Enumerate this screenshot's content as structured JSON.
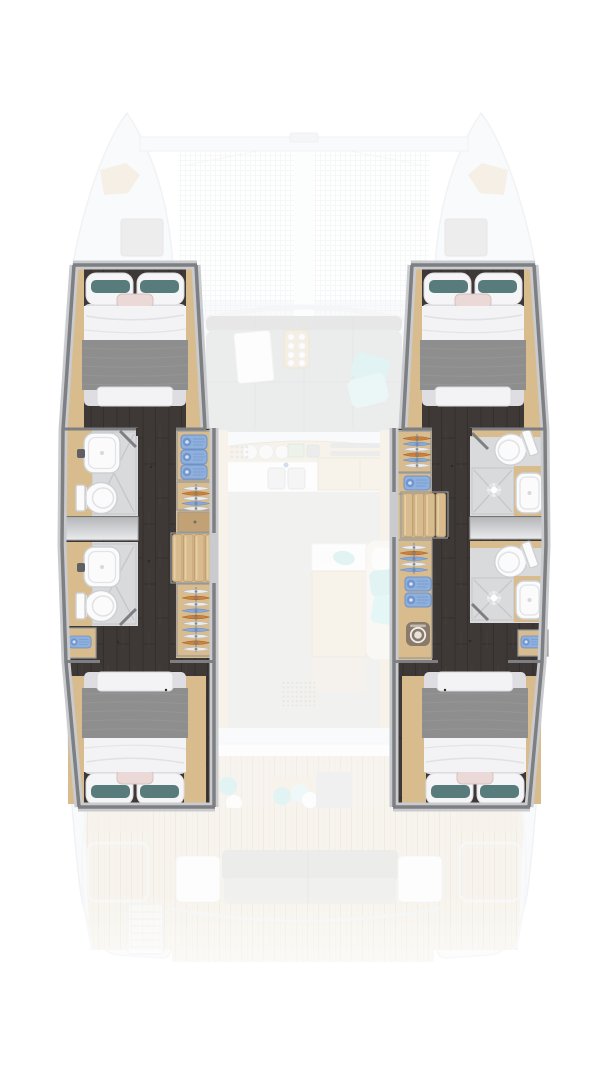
{
  "plan": {
    "vessel": "catamaran",
    "view": "top-down interior floor plan",
    "highlighted_layout": "4 double cabins and 4 shower rooms in the two hulls",
    "port_hull": {
      "forward_cabin": {
        "bed": "double, pillows forward",
        "pillow_accents": [
          "teal",
          "teal",
          "pink"
        ]
      },
      "shower_rooms": [
        {
          "fixtures": [
            "washbasin",
            "shower",
            "toilet"
          ]
        },
        {
          "fixtures": [
            "washbasin",
            "shower",
            "toilet"
          ]
        }
      ],
      "hull_window": true,
      "wardrobe_shelf_towels": 3,
      "hanging_rails": 2,
      "companionway_steps": 4,
      "towel_cabinet": true,
      "aft_cabin": {
        "bed": "double, pillows aft",
        "pillow_accents": [
          "teal",
          "teal",
          "pink"
        ]
      }
    },
    "starboard_hull": {
      "forward_cabin": {
        "bed": "double, pillows forward",
        "pillow_accents": [
          "teal",
          "teal",
          "pink"
        ]
      },
      "shower_rooms": [
        {
          "fixtures": [
            "toilet",
            "shower",
            "washbasin"
          ]
        },
        {
          "fixtures": [
            "toilet",
            "shower",
            "washbasin"
          ]
        }
      ],
      "hull_window": true,
      "wardrobe_towels": 3,
      "hanging_rails": 2,
      "companionway_steps": 4,
      "washing_machine": true,
      "aft_cabin": {
        "bed": "double, pillows aft",
        "pillow_accents": [
          "teal",
          "teal",
          "pink"
        ]
      }
    },
    "faded_exterior": [
      "bow trampoline",
      "forward crossbeam",
      "deck hatches",
      "anchor lockers",
      "saloon sofa and table",
      "serving tray with cups",
      "galley with stove and double sink",
      "dinette table and sofa",
      "speaker grille",
      "sliding door",
      "cockpit teak deck",
      "aft bench",
      "side seats",
      "swim ladder"
    ],
    "icons": {
      "washing_machine": "washer-icon"
    }
  },
  "colors": {
    "page_bg": "#ffffff",
    "wall_gray": "#7d7f82",
    "wall_light": "#c9cbce",
    "floor_dark": "#3e3936",
    "floor_seam": "#332f2b",
    "floor_streak": "#4a433c",
    "oak": "#d9bc8e",
    "oak_dark": "#c2a274",
    "oak_light": "#e8d4ae",
    "tile": "#d9dadc",
    "tile_line": "#c4c6c9",
    "fixture": "#fbfbfc",
    "fixture_line": "#ced1d4",
    "duvet": "#f3f3f5",
    "duvet_shade": "#dddde2",
    "blanket": "#8e8e8e",
    "blanket_line": "#9c9c9c",
    "pillow_white": "#f5f5f7",
    "pillow_teal": "#577c7b",
    "pillow_pink": "#ead9d7",
    "towel_blue": "#8fb0dd",
    "towel_blue_dark": "#6e92c8",
    "hanger_white": "#ececee",
    "hanger_orange": "#c9813f",
    "hanger_blue": "#87a8d8",
    "window_a": "#b4b6b9",
    "window_b": "#eaebed",
    "washer": "#8a7a6b",
    "faded_hull": "#f5f6f8",
    "faded_line": "#e4e7ea",
    "mesh_line": "#e9ecef",
    "faded_sofa": "#d9dada",
    "faded_sofa_dark": "#d0d1d1",
    "faded_aqua": "#c6e8e9",
    "faded_aqua_light": "#d9f0f0",
    "faded_wood": "#f0e8d9",
    "faded_wood_line": "#e4d8c2",
    "faded_floor": "#e0e0df",
    "deck": "#f1eadd",
    "deck_line": "#e5dbc8",
    "bench": "#dbdbd9"
  }
}
